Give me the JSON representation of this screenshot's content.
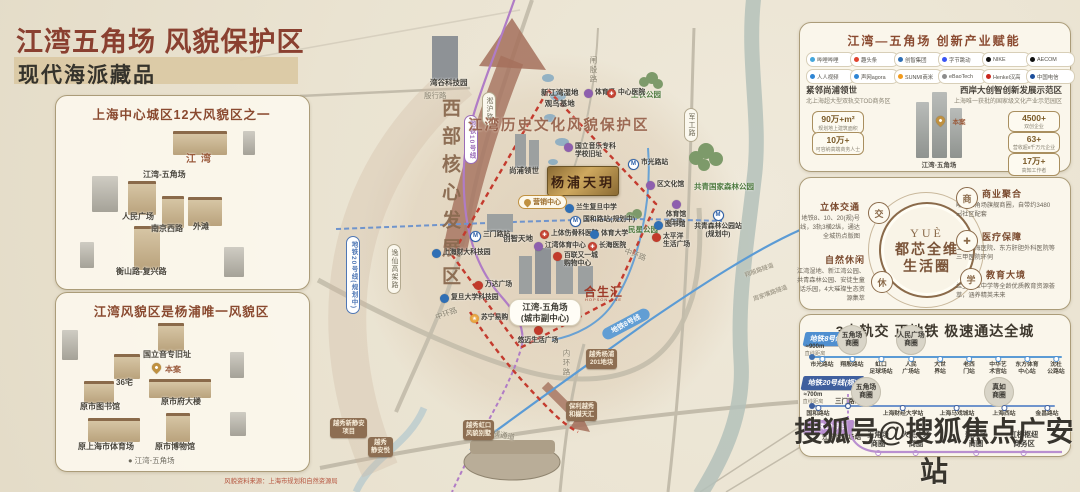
{
  "header": {
    "title": "江湾五角场 风貌保护区",
    "subtitle": "现代海派藏品"
  },
  "source_note": "风貌资料来源：上海市规划和自然资源局",
  "watermark": "搜狐号@搜狐焦点广安站",
  "panel12": {
    "title": "上海中心城区12大风貌区之一",
    "labels": [
      {
        "t": "江湾",
        "x": 186,
        "y": 150,
        "cls": "pl-brown"
      },
      {
        "t": "江湾-五角场",
        "x": 143,
        "y": 169
      },
      {
        "t": "人民广场",
        "x": 122,
        "y": 211
      },
      {
        "t": "南京西路",
        "x": 151,
        "y": 223
      },
      {
        "t": "外滩",
        "x": 193,
        "y": 221
      },
      {
        "t": "衡山路-复兴路",
        "x": 116,
        "y": 266
      }
    ]
  },
  "panelYp": {
    "title": "江湾风貌区是杨浦唯一风貌区",
    "pin_label": "本案",
    "labels": [
      {
        "t": "国立音专旧址",
        "x": 143,
        "y": 349
      },
      {
        "t": "36宅",
        "x": 116,
        "y": 377
      },
      {
        "t": "原市图书馆",
        "x": 80,
        "y": 401
      },
      {
        "t": "原市府大楼",
        "x": 161,
        "y": 396
      },
      {
        "t": "原上海市体育场",
        "x": 78,
        "y": 441
      },
      {
        "t": "原市博物馆",
        "x": 155,
        "y": 441
      },
      {
        "t": "● 江湾-五角场",
        "x": 128,
        "y": 455,
        "cls": "pl-dim"
      }
    ]
  },
  "map": {
    "labels": [
      {
        "t": "殷行路",
        "x": 424,
        "y": 90,
        "cls": "road"
      },
      {
        "t": "闸殷路",
        "x": 588,
        "y": 56,
        "cls": "road vtx"
      },
      {
        "t": "军工路",
        "x": 684,
        "y": 108,
        "cls": "roadpill"
      },
      {
        "t": "淞沪路",
        "x": 482,
        "y": 92,
        "cls": "roadpill"
      },
      {
        "t": "逸仙高架路",
        "x": 387,
        "y": 244,
        "cls": "roadpill"
      },
      {
        "t": "中环路",
        "x": 435,
        "y": 308,
        "cls": "road rm20"
      },
      {
        "t": "中环路",
        "x": 624,
        "y": 249,
        "cls": "road rp20"
      },
      {
        "t": "内环路",
        "x": 561,
        "y": 349,
        "cls": "road vtx"
      },
      {
        "t": "北横通道",
        "x": 485,
        "y": 429,
        "cls": "road rp12"
      },
      {
        "t": "翔殷路隧道",
        "x": 744,
        "y": 265,
        "cls": "road sm rm20"
      },
      {
        "t": "周家嘴路隧道",
        "x": 752,
        "y": 288,
        "cls": "road sm rm20"
      },
      {
        "t": "地铁10号线",
        "x": 464,
        "y": 115,
        "cls": "mpill purple"
      },
      {
        "t": "地铁20号线(规划中)",
        "x": 346,
        "y": 236,
        "cls": "mpill blue"
      },
      {
        "t": "地铁8号线",
        "x": 600,
        "y": 318,
        "cls": "mribbon rm28"
      },
      {
        "t": "西部核心发展区",
        "x": 436,
        "y": 98,
        "cls": "vertbig"
      },
      {
        "t": "江湾历史文化风貌保护区",
        "x": 468,
        "y": 114,
        "cls": "bigbrown"
      },
      {
        "t": "湾谷科技园",
        "x": 430,
        "y": 77,
        "cls": "dark"
      },
      {
        "t": "新江湾湿地\n观鸟基地",
        "x": 541,
        "y": 87,
        "cls": "dark ctr"
      },
      {
        "t": "尚浦领世",
        "x": 509,
        "y": 165,
        "cls": "dark"
      },
      {
        "t": "创智天地",
        "x": 503,
        "y": 233,
        "cls": "dark"
      },
      {
        "t": "共青国家森林公园",
        "x": 694,
        "y": 181,
        "cls": "green"
      },
      {
        "t": "工农公园",
        "x": 631,
        "y": 89,
        "cls": "green sm"
      },
      {
        "t": "民星公园",
        "x": 628,
        "y": 224,
        "cls": "green sm"
      }
    ],
    "pois": [
      {
        "t": "体育场",
        "x": 584,
        "y": 89,
        "icon": "civic"
      },
      {
        "t": "中心医院",
        "x": 607,
        "y": 89,
        "icon": "hospital"
      },
      {
        "t": "市光路站",
        "x": 628,
        "y": 159,
        "icon": "metro"
      },
      {
        "t": "区文化馆",
        "x": 646,
        "y": 181,
        "icon": "civic"
      },
      {
        "t": "体育馆\n(在建)",
        "x": 676,
        "y": 200,
        "icon": "civic",
        "cls": "vert"
      },
      {
        "t": "共青森林公园站\n(规划中)",
        "x": 718,
        "y": 210,
        "icon": "metro",
        "cls": "vert"
      },
      {
        "t": "图书馆",
        "x": 654,
        "y": 221,
        "icon": "blue"
      },
      {
        "t": "太平洋\n生活广场",
        "x": 652,
        "y": 233,
        "icon": "shop"
      },
      {
        "t": "国立音乐专科\n学校旧址",
        "x": 564,
        "y": 143,
        "icon": "civic"
      },
      {
        "t": "兰生复旦中学",
        "x": 565,
        "y": 204,
        "icon": "blue"
      },
      {
        "t": "国和路站(规划中)",
        "x": 570,
        "y": 216,
        "icon": "metro"
      },
      {
        "t": "三门路站",
        "x": 470,
        "y": 231,
        "icon": "metro"
      },
      {
        "t": "上体伤骨科医院",
        "x": 540,
        "y": 230,
        "icon": "hospital"
      },
      {
        "t": "体育大学",
        "x": 590,
        "y": 230,
        "icon": "blue"
      },
      {
        "t": "江湾体育中心",
        "x": 534,
        "y": 242,
        "icon": "civic"
      },
      {
        "t": "长海医院",
        "x": 588,
        "y": 242,
        "icon": "hospital"
      },
      {
        "t": "百联又一城\n购物中心",
        "x": 553,
        "y": 252,
        "icon": "shop"
      },
      {
        "t": "万达广场",
        "x": 474,
        "y": 281,
        "icon": "shop"
      },
      {
        "t": "复旦大学科技园",
        "x": 440,
        "y": 294,
        "icon": "blue"
      },
      {
        "t": "上海财大科技园",
        "x": 432,
        "y": 249,
        "icon": "blue"
      },
      {
        "t": "苏宁易购",
        "x": 470,
        "y": 314,
        "icon": "brand"
      },
      {
        "t": "悠迈生活广场",
        "x": 538,
        "y": 326,
        "icon": "shop",
        "cls": "vert"
      }
    ],
    "devpills": [
      {
        "t": "越秀杨浦\n201地块",
        "x": 586,
        "y": 349
      },
      {
        "t": "保利越秀\n和樾天汇",
        "x": 566,
        "y": 401
      },
      {
        "t": "越秀虹口\n风貌别墅",
        "x": 463,
        "y": 420
      },
      {
        "t": "越秀新静安\n项目",
        "x": 330,
        "y": 418
      },
      {
        "t": "越秀\n静安悦",
        "x": 368,
        "y": 437
      }
    ],
    "plaque": "杨浦天玥",
    "sales": "营销中心",
    "city_pill": "江湾-五角场\n(城市副中心)",
    "hopson": "合生汇",
    "hopson_sub": "HOPSON ONE"
  },
  "industry": {
    "title": "江湾—五角场  创新产业赋能",
    "logos": [
      {
        "t": "哔哩哔哩",
        "c": "#45a7dc"
      },
      {
        "t": "趣头条",
        "c": "#e0432e"
      },
      {
        "t": "创智集团",
        "c": "#2f6fb5"
      },
      {
        "t": "字节跳动",
        "c": "#3955f5"
      },
      {
        "t": "NIKE",
        "c": "#101010"
      },
      {
        "t": "AECOM",
        "c": "#101010"
      },
      {
        "t": "人人视频",
        "c": "#2f86d4"
      },
      {
        "t": "声网agora",
        "c": "#2f86d4"
      },
      {
        "t": "SUNMI商米",
        "c": "#f29b1d"
      },
      {
        "t": "eBaoTech",
        "c": "#8d8d8d"
      },
      {
        "t": "Henkel汉高",
        "c": "#c9271d"
      },
      {
        "t": "中国电信",
        "c": "#1c4f9c"
      }
    ],
    "left": {
      "h": "紧邻尚浦领世",
      "sub": "北上海超大型双轨交TOD商务区",
      "stats": [
        {
          "v": "90万+m²",
          "d": "规划地上建筑面积"
        },
        {
          "v": "10万+",
          "d": "可容纳高端商务人士"
        }
      ]
    },
    "right": {
      "h": "西岸大创智创新发展示范区",
      "sub": "上海唯一获批的国家级文化产业示范园区",
      "stats": [
        {
          "v": "4500+",
          "d": "双创企业"
        },
        {
          "v": "63+",
          "d": "营收超8千万元企业"
        },
        {
          "v": "17万+",
          "d": "高知工作者"
        }
      ]
    },
    "pin_label": "本案",
    "center_label": "江湾-五角场"
  },
  "life": {
    "brand": "YUÈ",
    "circle_line1": "都芯全维",
    "circle_line2": "生活圈",
    "cats": [
      {
        "h": "立体交通",
        "body": "地铁8、10、20(规)号线，3轨3横2纵，通达全城热点版图",
        "glyph": "交"
      },
      {
        "h": "自然休闲",
        "body": "江湾湿地、新江湾公园、共青森林公园、安徒生童话乐园，4大璀璨生态资源集萃",
        "glyph": "休"
      },
      {
        "h": "商业聚合",
        "body": "毗邻五角场旗舰商圈，自带约3480㎡社区配套",
        "glyph": "商"
      },
      {
        "h": "医疗保障",
        "body": "上海长海医院、东方肝胆外科医院等三甲医院环伺",
        "glyph": "✚"
      },
      {
        "h": "教育大境",
        "body": "兰生复旦中学等全龄优质教育资源荟萃，涵养精英未来",
        "glyph": "学"
      }
    ]
  },
  "metro": {
    "title": "3大轨交 正地铁 极速通达全城",
    "line8": {
      "badge": "地铁8号线",
      "dist": "≈900m",
      "dist_note": "直线距离",
      "bubbles": [
        {
          "t": "五角场\n商圈",
          "x": 852
        },
        {
          "t": "人民广场\n商圈",
          "x": 911
        }
      ],
      "stations": [
        {
          "t": "市光路站",
          "x": 822
        },
        {
          "t": "翔殷路站",
          "x": 852
        },
        {
          "t": "虹口\n足球场站",
          "x": 881
        },
        {
          "t": "人民\n广场站",
          "x": 911
        },
        {
          "t": "大世\n界站",
          "x": 940
        },
        {
          "t": "老西\n门站",
          "x": 969
        },
        {
          "t": "中华艺\n术宫站",
          "x": 998
        },
        {
          "t": "东方体育\n中心站",
          "x": 1027
        },
        {
          "t": "沈杜\n公路站",
          "x": 1056
        }
      ]
    },
    "line20": {
      "badge": "地铁20号线(规)",
      "dist": "≈700m",
      "dist_note": "直线距离",
      "branch": "三门路站",
      "bubbles": [
        {
          "t": "五角场\n商圈",
          "x": 866
        },
        {
          "t": "真如\n商圈",
          "x": 999
        }
      ],
      "stations": [
        {
          "t": "国和路站",
          "x": 818
        },
        {
          "t": "上海财经大学站",
          "x": 903
        },
        {
          "t": "上海马戏城站",
          "x": 957
        },
        {
          "t": "上海西站",
          "x": 1004
        },
        {
          "t": "金昌路站",
          "x": 1047
        }
      ]
    },
    "line10": {
      "badge": "地铁10号线",
      "start": "江湾体育场站",
      "hubs": [
        {
          "t": "五角场\n商圈",
          "x": 878
        },
        {
          "t": "人民广场\n商圈",
          "x": 916
        },
        {
          "t": "新天地\n商圈",
          "x": 976
        },
        {
          "t": "虹桥枢纽\n商务区",
          "x": 1024
        }
      ]
    }
  }
}
